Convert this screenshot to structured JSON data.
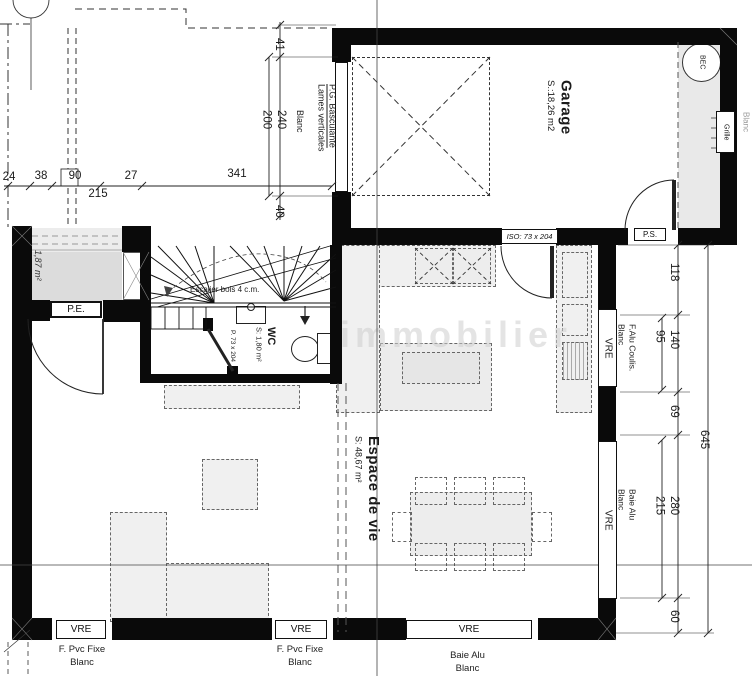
{
  "watermark": "immobilier",
  "rooms": {
    "garage": {
      "name": "Garage",
      "area": "S.:18,26 m2"
    },
    "living": {
      "name": "Espace de vie",
      "area": "S: 48,67 m²"
    },
    "wc": {
      "name": "WC",
      "area": "S: 1,80 m²"
    },
    "porch_area": "1,87 m²",
    "stairs": "Escalier bois 4 c.m."
  },
  "doors": {
    "entry": "P.E.",
    "service": "P.S.",
    "garage_living": "ISO: 73 x 204",
    "wc_door": "P. 73 x 204",
    "garage_main_line1": "P.G. Basculante",
    "garage_main_line2": "Lames verticales",
    "garage_main_color": "Blanc"
  },
  "fixtures": {
    "spout": "BEC",
    "vent": "Grille",
    "vent_color": "Blanc"
  },
  "windows": {
    "vre": "VRE",
    "right_top_line1": "F.Alu Coulis.",
    "right_top_line2": "Blanc",
    "right_bottom_line1": "Baie Alu",
    "right_bottom_line2": "Blanc",
    "bottom_left_line1": "F. Pvc Fixe",
    "bottom_left_line2": "Blanc",
    "bottom_mid_line1": "F. Pvc Fixe",
    "bottom_mid_line2": "Blanc",
    "bottom_right_line1": "Baie Alu",
    "bottom_right_line2": "Blanc"
  },
  "dimensions": {
    "top": {
      "d24": "24",
      "d38": "38",
      "d90": "90",
      "d27": "27",
      "d341": "341",
      "d215": "215"
    },
    "garage_door": {
      "d41": "41",
      "d240": "240",
      "d200": "200",
      "d40": "40"
    },
    "right": {
      "d118": "118",
      "d140": "140",
      "d95": "95",
      "d69": "69",
      "d645": "645",
      "d280": "280",
      "d215": "215",
      "d60": "60"
    }
  },
  "colors": {
    "wall": "#0a0a0a",
    "line": "#222222",
    "furniture_fill": "#f0f0f0",
    "porch_fill": "#dcdcdc",
    "watermark": "#cfcfcf"
  }
}
